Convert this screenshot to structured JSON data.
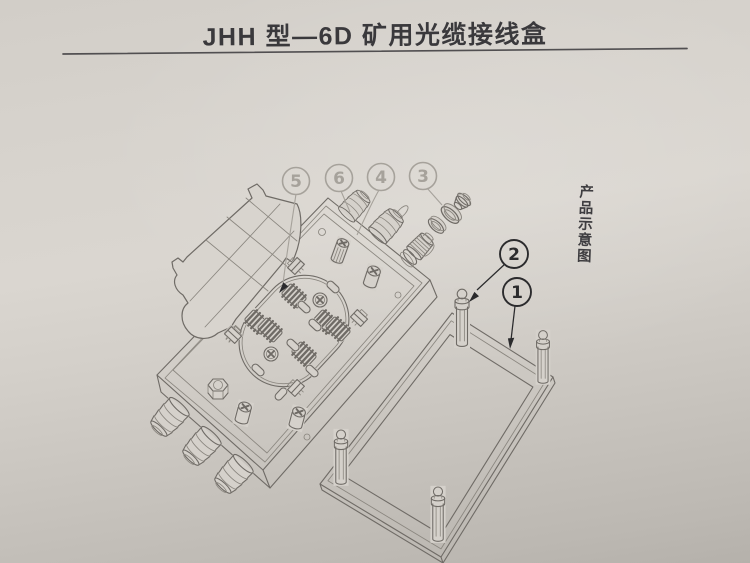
{
  "document": {
    "title": "JHH 型—6D 矿用光缆接线盒",
    "side_caption": "产品示意图"
  },
  "callouts": {
    "faded": [
      "5",
      "6",
      "4",
      "3"
    ],
    "dark": [
      "2",
      "1"
    ]
  },
  "colors": {
    "paper_fill": "#d5d1cb",
    "flap_fill": "#d8d4ce",
    "ink_title": "#3a393c",
    "underline": "#514f51",
    "line_main": "#6f6b66",
    "line_soft": "#8a867f",
    "line_faint": "#a6a29b",
    "line_dark": "#2b2b2d"
  }
}
